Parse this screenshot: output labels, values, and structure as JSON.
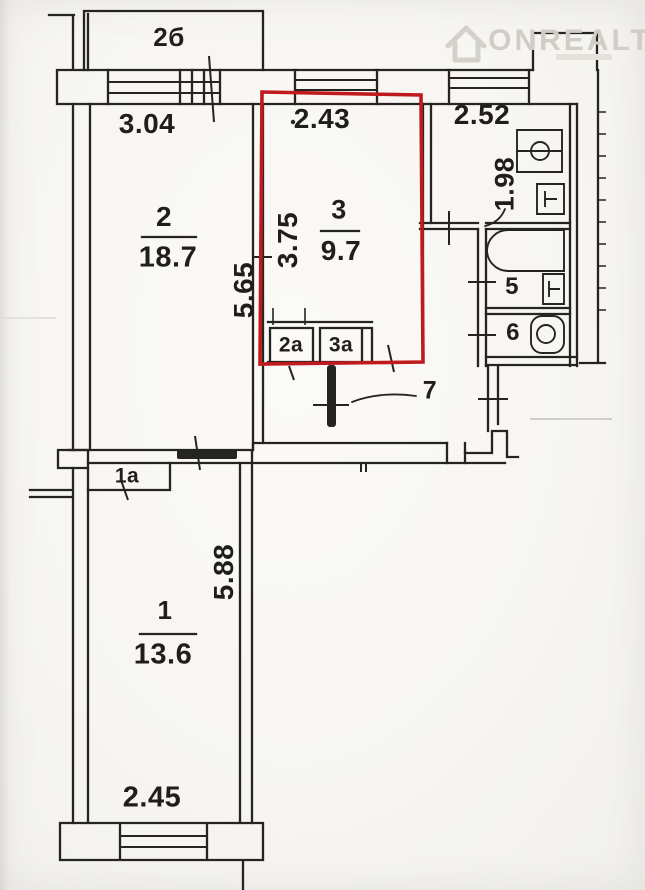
{
  "watermark": {
    "brand": "ONREALT"
  },
  "colors": {
    "highlight_red": "#bf1a1e",
    "ink": "#262423",
    "paper": "#f6f5f2",
    "watermark_gray": "#d0cdc6"
  },
  "plan": {
    "balcony_label": "2б",
    "rooms": {
      "room1": {
        "number": "1",
        "area": "13.6"
      },
      "room1a": {
        "number": "1а"
      },
      "room2": {
        "number": "2",
        "area": "18.7"
      },
      "room2a": {
        "number": "2а"
      },
      "room3": {
        "number": "3",
        "area": "9.7"
      },
      "room3a": {
        "number": "3а"
      },
      "room5": {
        "number": "5"
      },
      "room6": {
        "number": "6"
      },
      "room7": {
        "number": "7"
      }
    },
    "dimensions": {
      "top_left": "3.04",
      "top_middle": "2.43",
      "top_right": "2.52",
      "kitchen_depth": "1.98",
      "room2_depth": "5.65",
      "room3_depth": "3.75",
      "room1_depth": "5.88",
      "room1_width": "2.45"
    }
  }
}
